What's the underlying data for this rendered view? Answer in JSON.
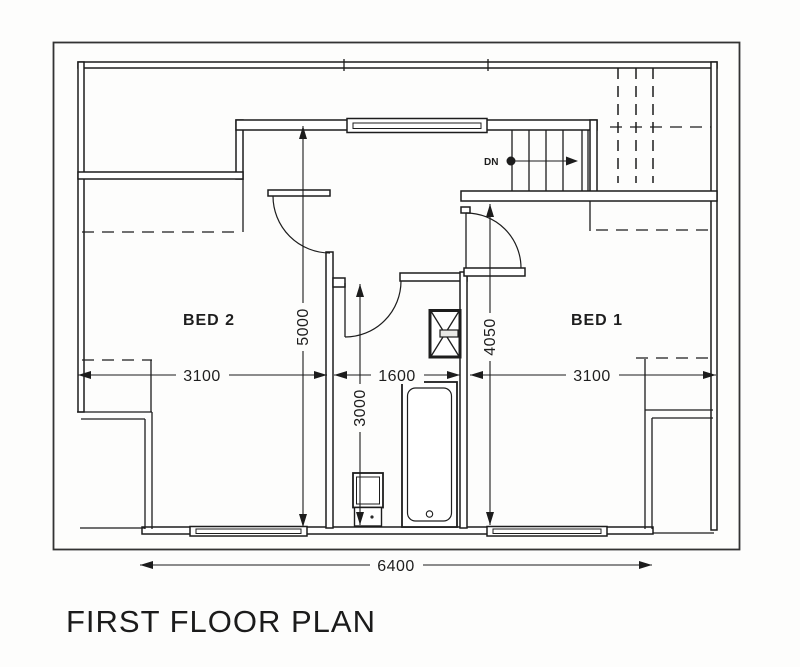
{
  "title": "FIRST FLOOR PLAN",
  "rooms": {
    "bed1": {
      "label": "BED 1"
    },
    "bed2": {
      "label": "BED 2"
    }
  },
  "stairs": {
    "direction_label": "DN"
  },
  "dimensions": {
    "bed2_width_mm": "3100",
    "bathroom_width_mm": "1600",
    "bed1_width_mm": "3100",
    "overall_width_mm": "6400",
    "landing_depth_mm": "5000",
    "bathroom_depth_mm": "3000",
    "bed1_depth_mm": "4050"
  },
  "colors": {
    "line": "#1d1d1d",
    "background": "#fdfdfc",
    "wall_fill": "#ffffff"
  }
}
